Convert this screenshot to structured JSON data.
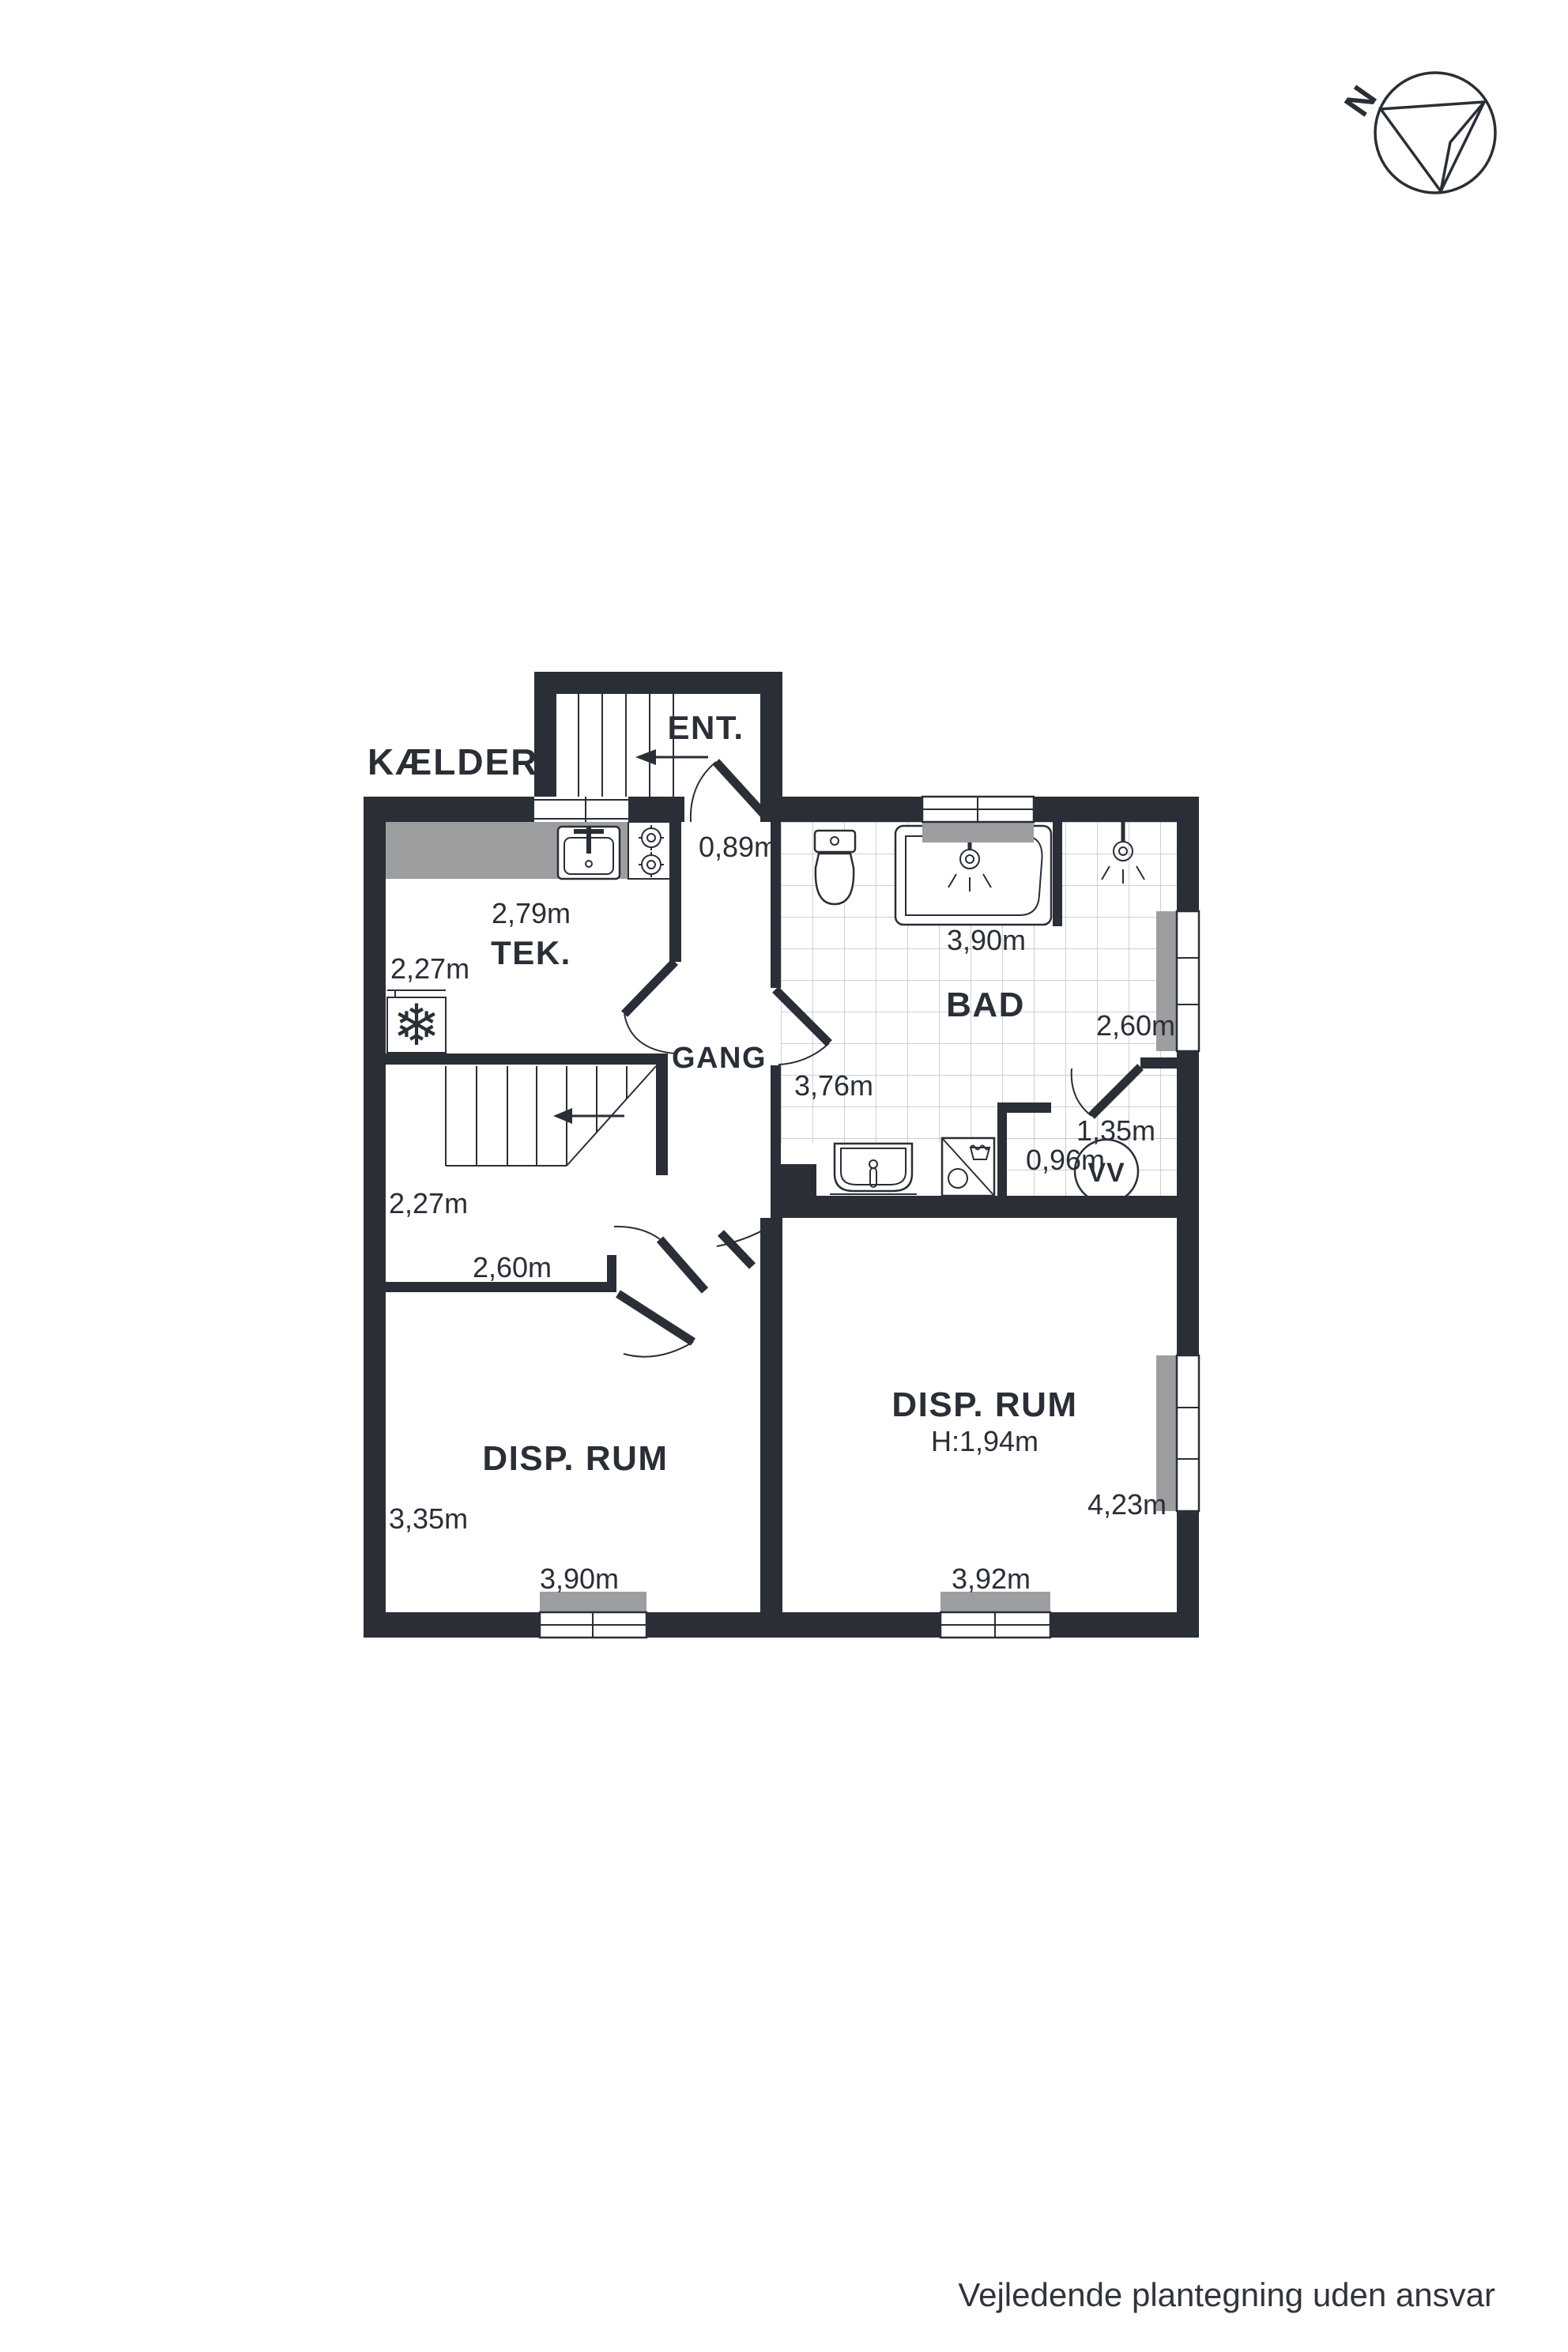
{
  "title": "KÆLDER",
  "disclaimer": "Vejledende plantegning uden ansvar",
  "compass": {
    "north_label": "N"
  },
  "colors": {
    "wall": "#2a2e36",
    "fixture_gray": "#9c9ea0",
    "tile_line": "#bcc0c5"
  },
  "icons": {
    "freezer_glyph": "❄"
  },
  "rooms": {
    "ent": {
      "label": "ENT.",
      "door_width": "0,89m"
    },
    "tek": {
      "label": "TEK.",
      "width": "2,79m",
      "depth": "2,27m"
    },
    "gang": {
      "label": "GANG"
    },
    "stairs": {
      "width": "2,27m"
    },
    "hall": {
      "wall_width": "2,60m"
    },
    "bad": {
      "label": "BAD",
      "north_wall": "3,90m",
      "east_wall": "2,60m",
      "south_wall": "3,76m"
    },
    "vv": {
      "label": "VV",
      "width": "1,35m",
      "depth": "0,96m"
    },
    "disp_left": {
      "label": "DISP. RUM",
      "depth": "3,35m",
      "width": "3,90m"
    },
    "disp_right": {
      "label": "DISP. RUM",
      "ceiling_height": "H:1,94m",
      "depth": "4,23m",
      "width": "3,92m"
    }
  }
}
